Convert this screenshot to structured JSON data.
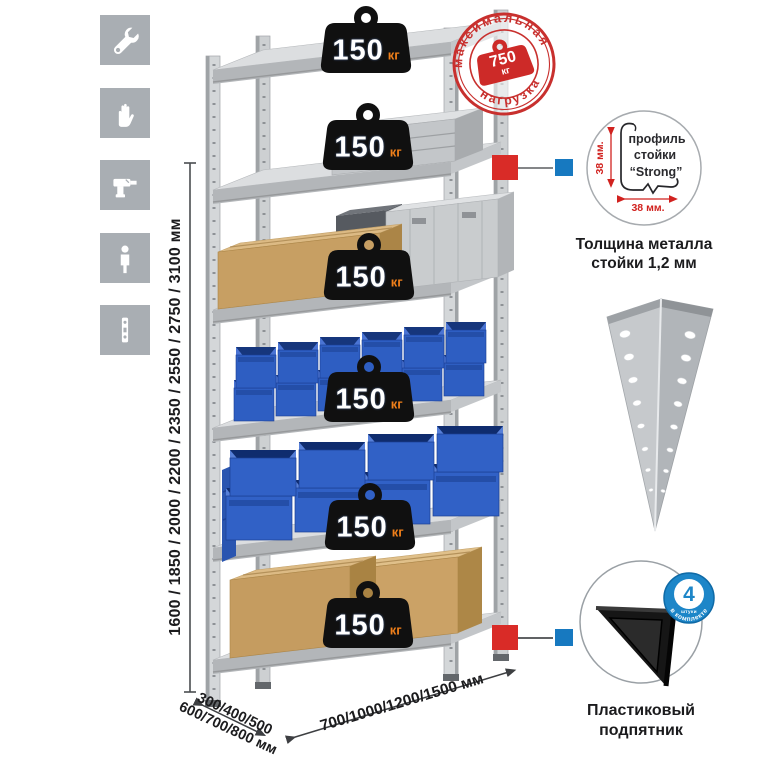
{
  "title": "Metal shelving rack infographic",
  "icons_column": {
    "items": [
      {
        "name": "wrench-icon"
      },
      {
        "name": "gloves-icon"
      },
      {
        "name": "drill-icon"
      },
      {
        "name": "person-icon"
      },
      {
        "name": "post-profile-icon"
      }
    ]
  },
  "stamp": {
    "top_text": "максимальная",
    "bottom_text": "нагрузка",
    "value": "750",
    "unit": "кг",
    "color": "#c8302e"
  },
  "weights": {
    "unit": "кг",
    "items": [
      "150",
      "150",
      "150",
      "150",
      "150",
      "150"
    ]
  },
  "dimensions": {
    "height": "1600 / 1850 / 2000 / 2200 / 2350 / 2550 / 2750 / 3100 мм",
    "depth1": "300/400/500",
    "depth2": "600/700/800 мм",
    "width": "700/1000/1200/1500 мм"
  },
  "profile_detail": {
    "line1": "профиль",
    "line2": "стойки",
    "line3": "“Strong”",
    "dim_vertical": "38 мм.",
    "dim_horizontal": "38 мм.",
    "caption1": "Толщина металла",
    "caption2": "стойки 1,2 мм"
  },
  "foot_detail": {
    "caption1": "Пластиковый",
    "caption2": "подпятник",
    "badge_value": "4",
    "badge_small": "штуки",
    "badge_arc": "в комплекте",
    "badge_color": "#1d86c8"
  },
  "colors": {
    "stamp_red": "#c8302e",
    "connector_red": "#d92b27",
    "connector_blue": "#1779c0",
    "bin_blue": "#2e5ec2",
    "kg_orange": "#ef7f1a",
    "icon_gray": "#a9aeb3",
    "metal_gray": "#c9ccce"
  }
}
